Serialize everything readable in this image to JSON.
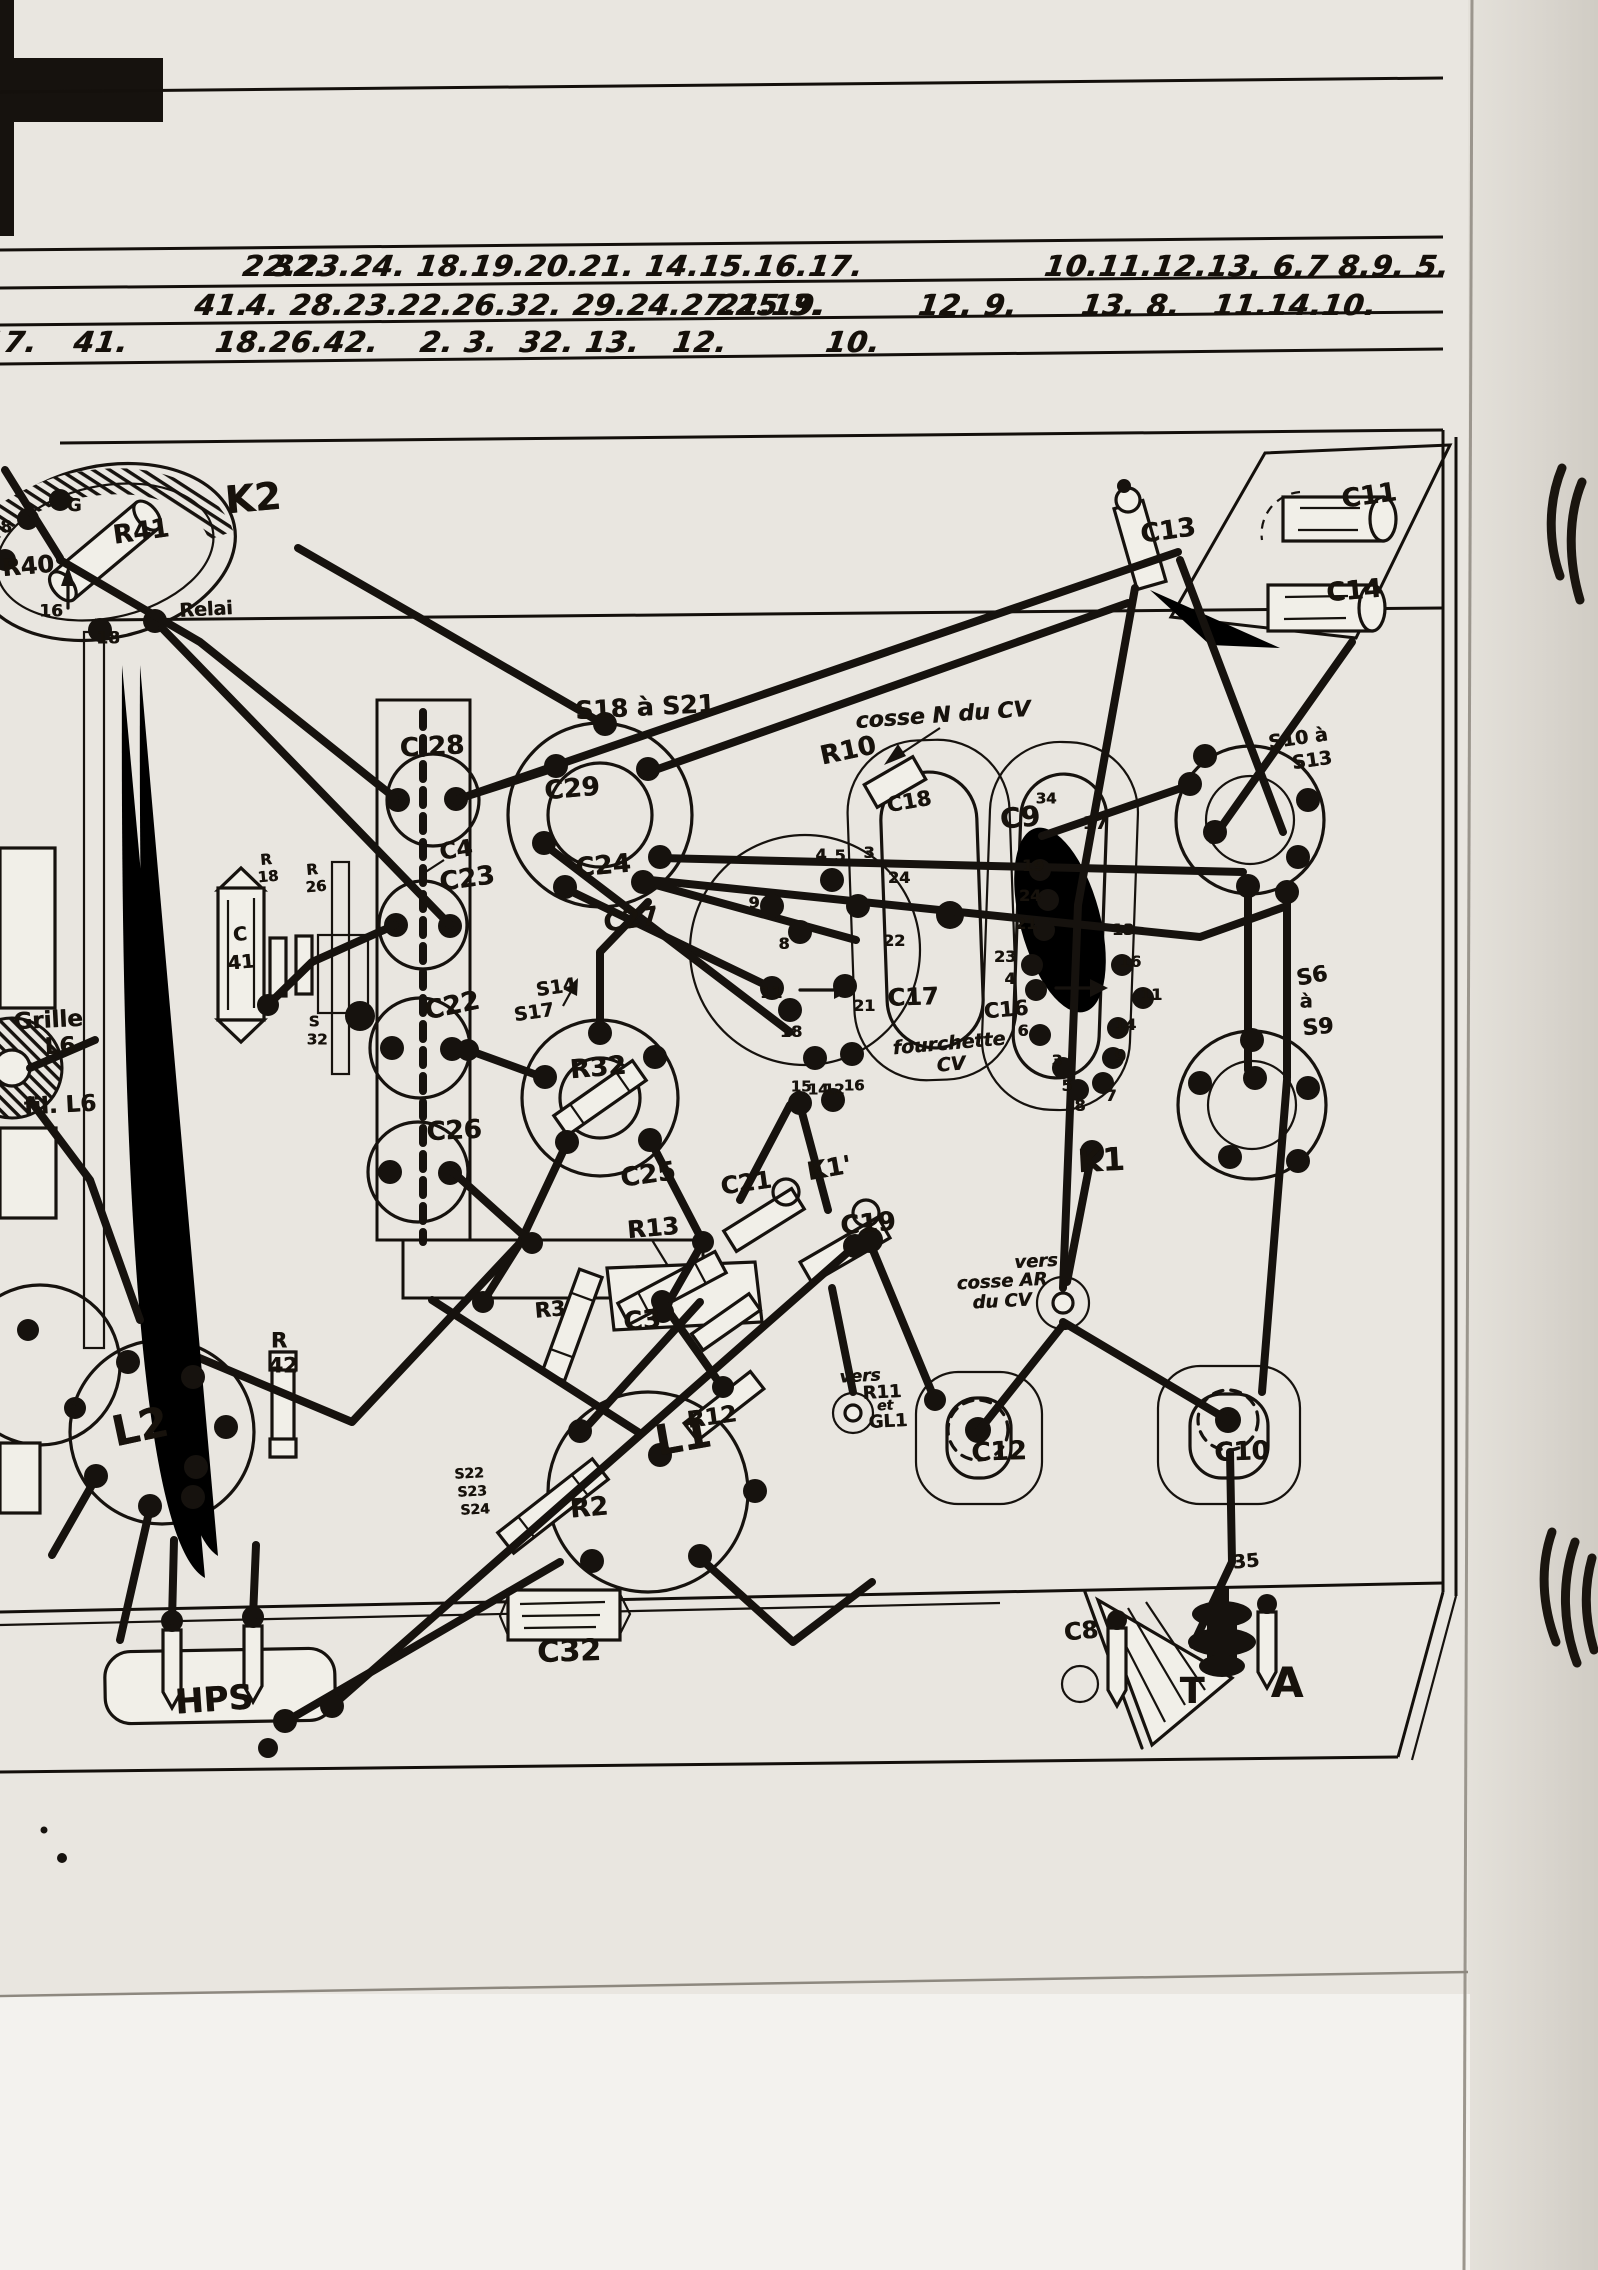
{
  "page": {
    "type": "scanned hand-drawn radio chassis wiring diagram",
    "paper_color": "#e9e6e0",
    "ink_color": "#16120e"
  },
  "header_rows": [
    {
      "y": 266,
      "items": [
        {
          "t": "32.",
          "x": 300
        },
        {
          "t": "22.23.24. 18.19.20.21. 14.15.16.17.",
          "x": 553
        },
        {
          "t": "10.11.12.13. 6.7 8.9. 5.",
          "x": 1247
        }
      ]
    },
    {
      "y": 305,
      "items": [
        {
          "t": "41.",
          "x": 222
        },
        {
          "t": "4. 28.23.22.26.32. 29.24.27.25.3.",
          "x": 535
        },
        {
          "t": "21.19.",
          "x": 772
        },
        {
          "t": "12. 9.",
          "x": 968
        },
        {
          "t": "13. 8.   11.14.10.",
          "x": 1229
        }
      ]
    },
    {
      "y": 342,
      "items": [
        {
          "t": "17.",
          "x": 10
        },
        {
          "t": "41.",
          "x": 101
        },
        {
          "t": "18.26.42.",
          "x": 297
        },
        {
          "t": "2. 3.  32. 13.",
          "x": 530
        },
        {
          "t": "12.",
          "x": 700
        },
        {
          "t": "10.",
          "x": 853
        }
      ]
    }
  ],
  "labels": [
    {
      "t": "K2",
      "x": 253,
      "y": 498,
      "s": 38,
      "r": -5
    },
    {
      "t": "R41",
      "x": 141,
      "y": 532,
      "s": 26,
      "r": -8
    },
    {
      "t": "R40",
      "x": 28,
      "y": 566,
      "s": 24,
      "r": -5
    },
    {
      "t": "Relai",
      "x": 206,
      "y": 610,
      "s": 19,
      "r": -3
    },
    {
      "t": "G",
      "x": 74,
      "y": 506,
      "s": 18,
      "r": 0
    },
    {
      "t": "16",
      "x": 51,
      "y": 612,
      "s": 17,
      "r": 0
    },
    {
      "t": "18",
      "x": 108,
      "y": 639,
      "s": 17,
      "r": 0
    },
    {
      "t": "8",
      "x": 6,
      "y": 528,
      "s": 17,
      "r": 0
    },
    {
      "t": "C13",
      "x": 1168,
      "y": 531,
      "s": 26,
      "r": -8
    },
    {
      "t": "C11",
      "x": 1369,
      "y": 496,
      "s": 26,
      "r": -8
    },
    {
      "t": "C14",
      "x": 1354,
      "y": 591,
      "s": 26,
      "r": -5
    },
    {
      "t": "C 28",
      "x": 432,
      "y": 747,
      "s": 26,
      "r": -3
    },
    {
      "t": "C4",
      "x": 456,
      "y": 851,
      "s": 23,
      "r": -8
    },
    {
      "t": "C23",
      "x": 467,
      "y": 879,
      "s": 26,
      "r": -8
    },
    {
      "t": "C22",
      "x": 452,
      "y": 1006,
      "s": 26,
      "r": -12
    },
    {
      "t": "C26",
      "x": 454,
      "y": 1131,
      "s": 26,
      "r": -3
    },
    {
      "t": "S18 à S21",
      "x": 645,
      "y": 707,
      "s": 25,
      "r": -3
    },
    {
      "t": "C29",
      "x": 572,
      "y": 789,
      "s": 26,
      "r": -5
    },
    {
      "t": "C24",
      "x": 603,
      "y": 866,
      "s": 26,
      "r": -5
    },
    {
      "t": "C27",
      "x": 631,
      "y": 920,
      "s": 26,
      "r": -8
    },
    {
      "t": "S14",
      "x": 556,
      "y": 988,
      "s": 19,
      "r": -8
    },
    {
      "t": "S17",
      "x": 534,
      "y": 1013,
      "s": 19,
      "r": -8
    },
    {
      "t": "R32",
      "x": 598,
      "y": 1068,
      "s": 26,
      "r": -5
    },
    {
      "t": "C25",
      "x": 648,
      "y": 1175,
      "s": 26,
      "r": -8
    },
    {
      "t": "R10",
      "x": 848,
      "y": 751,
      "s": 26,
      "r": -12
    },
    {
      "t": "cosse N du CV",
      "x": 943,
      "y": 716,
      "s": 22,
      "r": -4,
      "i": 1
    },
    {
      "t": "C18",
      "x": 909,
      "y": 802,
      "s": 21,
      "r": -10
    },
    {
      "t": "C17",
      "x": 913,
      "y": 997,
      "s": 24,
      "r": -2
    },
    {
      "t": "fourchette",
      "x": 949,
      "y": 1044,
      "s": 19,
      "r": -5,
      "i": 1
    },
    {
      "t": "CV",
      "x": 951,
      "y": 1065,
      "s": 19,
      "r": -5,
      "i": 1
    },
    {
      "t": "C9",
      "x": 1020,
      "y": 818,
      "s": 28,
      "r": -5
    },
    {
      "t": "C16",
      "x": 1006,
      "y": 1010,
      "s": 21,
      "r": -5
    },
    {
      "t": "K1",
      "x": 1101,
      "y": 1160,
      "s": 32,
      "r": -3
    },
    {
      "t": "S10 à",
      "x": 1298,
      "y": 739,
      "s": 19,
      "r": -8
    },
    {
      "t": "S13",
      "x": 1312,
      "y": 761,
      "s": 19,
      "r": -8
    },
    {
      "t": "S6",
      "x": 1312,
      "y": 977,
      "s": 22,
      "r": -10
    },
    {
      "t": "à",
      "x": 1306,
      "y": 1002,
      "s": 19,
      "r": 0
    },
    {
      "t": "S9",
      "x": 1318,
      "y": 1028,
      "s": 22,
      "r": -5
    },
    {
      "t": "C21",
      "x": 746,
      "y": 1183,
      "s": 24,
      "r": -8
    },
    {
      "t": "K1'",
      "x": 829,
      "y": 1168,
      "s": 25,
      "r": -10
    },
    {
      "t": "C19",
      "x": 868,
      "y": 1224,
      "s": 26,
      "r": -5
    },
    {
      "t": "R13",
      "x": 653,
      "y": 1228,
      "s": 24,
      "r": -5
    },
    {
      "t": "C3",
      "x": 642,
      "y": 1321,
      "s": 26,
      "r": -5
    },
    {
      "t": "R3",
      "x": 550,
      "y": 1310,
      "s": 21,
      "r": -5
    },
    {
      "t": "R12",
      "x": 712,
      "y": 1418,
      "s": 23,
      "r": -8
    },
    {
      "t": "R2",
      "x": 589,
      "y": 1508,
      "s": 26,
      "r": -5
    },
    {
      "t": "C32",
      "x": 569,
      "y": 1652,
      "s": 30,
      "r": -2
    },
    {
      "t": "L1",
      "x": 683,
      "y": 1437,
      "s": 42,
      "r": -10
    },
    {
      "t": "L2",
      "x": 140,
      "y": 1427,
      "s": 42,
      "r": -12
    },
    {
      "t": "R",
      "x": 279,
      "y": 1341,
      "s": 21,
      "r": 0
    },
    {
      "t": "42",
      "x": 283,
      "y": 1366,
      "s": 21,
      "r": 0
    },
    {
      "t": "R",
      "x": 266,
      "y": 860,
      "s": 15,
      "r": -5
    },
    {
      "t": "18",
      "x": 268,
      "y": 877,
      "s": 15,
      "r": -5
    },
    {
      "t": "R",
      "x": 312,
      "y": 870,
      "s": 15,
      "r": -5
    },
    {
      "t": "26",
      "x": 316,
      "y": 887,
      "s": 15,
      "r": -5
    },
    {
      "t": "S",
      "x": 314,
      "y": 1022,
      "s": 15,
      "r": 0
    },
    {
      "t": "32",
      "x": 317,
      "y": 1040,
      "s": 15,
      "r": 0
    },
    {
      "t": "C",
      "x": 240,
      "y": 935,
      "s": 19,
      "r": -5
    },
    {
      "t": "41",
      "x": 241,
      "y": 963,
      "s": 19,
      "r": -5
    },
    {
      "t": "Grille",
      "x": 48,
      "y": 1021,
      "s": 23,
      "r": -3
    },
    {
      "t": "L6",
      "x": 60,
      "y": 1047,
      "s": 23,
      "r": -3
    },
    {
      "t": "fil. L6",
      "x": 60,
      "y": 1106,
      "s": 23,
      "r": -3
    },
    {
      "t": "S22",
      "x": 469,
      "y": 1474,
      "s": 14,
      "r": -3
    },
    {
      "t": "S23",
      "x": 472,
      "y": 1492,
      "s": 14,
      "r": -3
    },
    {
      "t": "S24",
      "x": 475,
      "y": 1510,
      "s": 14,
      "r": -3
    },
    {
      "t": "HPS",
      "x": 214,
      "y": 1700,
      "s": 34,
      "r": -4
    },
    {
      "t": "C12",
      "x": 999,
      "y": 1452,
      "s": 26,
      "r": -2
    },
    {
      "t": "C10",
      "x": 1242,
      "y": 1452,
      "s": 26,
      "r": -2
    },
    {
      "t": "35",
      "x": 1246,
      "y": 1562,
      "s": 19,
      "r": -5
    },
    {
      "t": "vers",
      "x": 1036,
      "y": 1262,
      "s": 18,
      "r": -3,
      "i": 1
    },
    {
      "t": "cosse AR",
      "x": 1002,
      "y": 1282,
      "s": 18,
      "r": -3,
      "i": 1
    },
    {
      "t": "du CV",
      "x": 1002,
      "y": 1302,
      "s": 18,
      "r": -3,
      "i": 1
    },
    {
      "t": "C8",
      "x": 1081,
      "y": 1631,
      "s": 24,
      "r": -5
    },
    {
      "t": "T",
      "x": 1192,
      "y": 1692,
      "s": 36,
      "r": 0
    },
    {
      "t": "A",
      "x": 1287,
      "y": 1683,
      "s": 42,
      "r": 0
    },
    {
      "t": "vers",
      "x": 860,
      "y": 1377,
      "s": 17,
      "r": -3,
      "i": 1
    },
    {
      "t": "R11",
      "x": 882,
      "y": 1393,
      "s": 18,
      "r": -3
    },
    {
      "t": "et",
      "x": 885,
      "y": 1406,
      "s": 14,
      "r": -3,
      "i": 1
    },
    {
      "t": "GL1",
      "x": 888,
      "y": 1422,
      "s": 18,
      "r": -3
    },
    {
      "t": "4",
      "x": 821,
      "y": 855,
      "s": 16,
      "n": "pin-label"
    },
    {
      "t": "5",
      "x": 840,
      "y": 856,
      "s": 16,
      "n": "pin-label"
    },
    {
      "t": "3",
      "x": 869,
      "y": 853,
      "s": 16,
      "n": "pin-label"
    },
    {
      "t": "24",
      "x": 899,
      "y": 878,
      "s": 16,
      "n": "pin-label"
    },
    {
      "t": "9",
      "x": 754,
      "y": 903,
      "s": 16,
      "n": "pin-label"
    },
    {
      "t": "8",
      "x": 784,
      "y": 944,
      "s": 16,
      "n": "pin-label"
    },
    {
      "t": "22",
      "x": 894,
      "y": 941,
      "s": 16,
      "n": "pin-label"
    },
    {
      "t": "11",
      "x": 771,
      "y": 993,
      "s": 16,
      "n": "pin-label"
    },
    {
      "t": "21",
      "x": 864,
      "y": 1006,
      "s": 16,
      "n": "pin-label"
    },
    {
      "t": "18",
      "x": 791,
      "y": 1032,
      "s": 16,
      "n": "pin-label"
    },
    {
      "t": "15",
      "x": 801,
      "y": 1087,
      "s": 15,
      "n": "pin-label"
    },
    {
      "t": "14",
      "x": 818,
      "y": 1090,
      "s": 15,
      "n": "pin-label"
    },
    {
      "t": "12",
      "x": 834,
      "y": 1090,
      "s": 15,
      "n": "pin-label"
    },
    {
      "t": "16",
      "x": 854,
      "y": 1086,
      "s": 15,
      "n": "pin-label"
    },
    {
      "t": "19",
      "x": 1033,
      "y": 866,
      "s": 16,
      "n": "pin-label"
    },
    {
      "t": "24",
      "x": 1030,
      "y": 896,
      "s": 16,
      "n": "pin-label"
    },
    {
      "t": "21",
      "x": 1026,
      "y": 924,
      "s": 16,
      "n": "pin-label"
    },
    {
      "t": "23",
      "x": 1005,
      "y": 957,
      "s": 16,
      "n": "pin-label"
    },
    {
      "t": "4",
      "x": 1010,
      "y": 979,
      "s": 16,
      "n": "pin-label"
    },
    {
      "t": "6",
      "x": 1023,
      "y": 1031,
      "s": 16,
      "n": "pin-label"
    },
    {
      "t": "3",
      "x": 1057,
      "y": 1061,
      "s": 16,
      "n": "pin-label"
    },
    {
      "t": "5",
      "x": 1067,
      "y": 1086,
      "s": 16,
      "n": "pin-label"
    },
    {
      "t": "8",
      "x": 1080,
      "y": 1106,
      "s": 16,
      "n": "pin-label"
    },
    {
      "t": "7",
      "x": 1111,
      "y": 1096,
      "s": 16,
      "n": "pin-label"
    },
    {
      "t": "9",
      "x": 1120,
      "y": 1057,
      "s": 18,
      "n": "pin-label"
    },
    {
      "t": "14",
      "x": 1125,
      "y": 1025,
      "s": 16,
      "n": "pin-label"
    },
    {
      "t": "16",
      "x": 1130,
      "y": 962,
      "s": 16,
      "n": "pin-label"
    },
    {
      "t": "11",
      "x": 1151,
      "y": 995,
      "s": 16,
      "n": "pin-label"
    },
    {
      "t": "13",
      "x": 1123,
      "y": 930,
      "s": 16,
      "n": "pin-label"
    },
    {
      "t": "17",
      "x": 1095,
      "y": 824,
      "s": 18,
      "n": "pin-label"
    },
    {
      "t": "34",
      "x": 1046,
      "y": 799,
      "s": 15,
      "n": "pin-label"
    }
  ]
}
